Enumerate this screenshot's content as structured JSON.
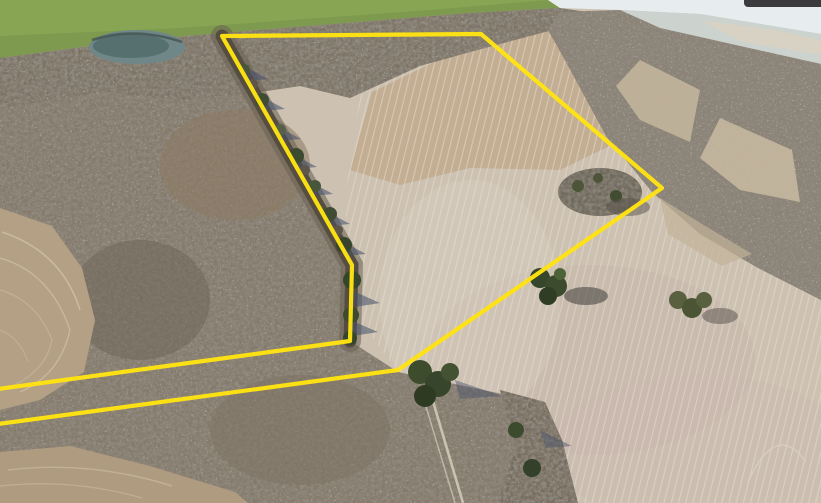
{
  "window": {
    "width": 821,
    "height": 503
  },
  "scene": {
    "kind": "aerial-drone-photograph",
    "subject": "Low-altitude winter aerial photo of farmland: a large bare plowed field outlined by a yellow property-boundary overlay, bordered by a leafless hedgerow tree line, dense gray woods on the left, a small pond at upper left, a green grass field strip along the top, and a hazy tree-covered hillside with sky at the upper right",
    "season": "winter / early spring (bare trees, dormant tan fields)",
    "visible_text": "none"
  },
  "palette": {
    "boundary_yellow": "#ffe312",
    "field_tan": "#cdc2b2",
    "field_warm_tan": "#c0a98b",
    "field_pink_tan": "#c3aea6",
    "woods_gray": "#837a6b",
    "woods_dark": "#554d40",
    "grass_green": "#7e9a4e",
    "pond_teal": "#6f8788",
    "pond_deep": "#55706f",
    "sky_haze": "#e7edef",
    "distant_haze": "#ccd2cd",
    "dirt_brown": "#b3a085",
    "dirt_contour_light": "#cdbc9f",
    "cedar_green": "#3c4a2e",
    "shadow_blue": "#47536b",
    "ui_bar_dark": "#3b3b3d"
  },
  "boundary": {
    "label": "property-line-overlay",
    "stroke_width": 4.2,
    "points_str": "222,36 481,34 662,188 398,370 -24,427 -24,392 350,341 352,265",
    "vertices_on_screen": [
      [
        222,
        36
      ],
      [
        481,
        34
      ],
      [
        662,
        188
      ],
      [
        398,
        370
      ],
      [
        350,
        341
      ],
      [
        352,
        265
      ]
    ],
    "note": "outline continues off the left edge of the frame between the two lower parallel lines"
  },
  "features": [
    {
      "name": "pond",
      "desc": "small dark teal pond ringed by bare trees, upper left"
    },
    {
      "name": "grass-field-top",
      "desc": "bright green pasture strip across the top left"
    },
    {
      "name": "sky-horizon",
      "desc": "pale hazy sky at the top right corner"
    },
    {
      "name": "right-hillside-woods",
      "desc": "gray leafless wooded hillside with tan grass openings, right side"
    },
    {
      "name": "left-woods",
      "desc": "large mass of bare gray-brown trees and brush, left half"
    },
    {
      "name": "contour-field-left",
      "desc": "brown plowed field with curved terrace contour lines at far left"
    },
    {
      "name": "contour-field-bottom-left",
      "desc": "brown plowed field with curved lines, bottom left corner"
    },
    {
      "name": "main-plowed-field",
      "desc": "large light-tan plowed field with fine vertical plow striations, center and right"
    },
    {
      "name": "hedgerow-tree-line",
      "desc": "diagonal tree line with cedars and blue shadows along the field's left edge, following the yellow boundary"
    },
    {
      "name": "cedar-clusters",
      "desc": "isolated dark green cedar clumps with shadows inside the field"
    },
    {
      "name": "bottom-scrub",
      "desc": "brushy tree band and dirt two-track at bottom center"
    },
    {
      "name": "ui-bar-fragment",
      "desc": "dark rounded bar clipped at the very top right corner"
    }
  ]
}
